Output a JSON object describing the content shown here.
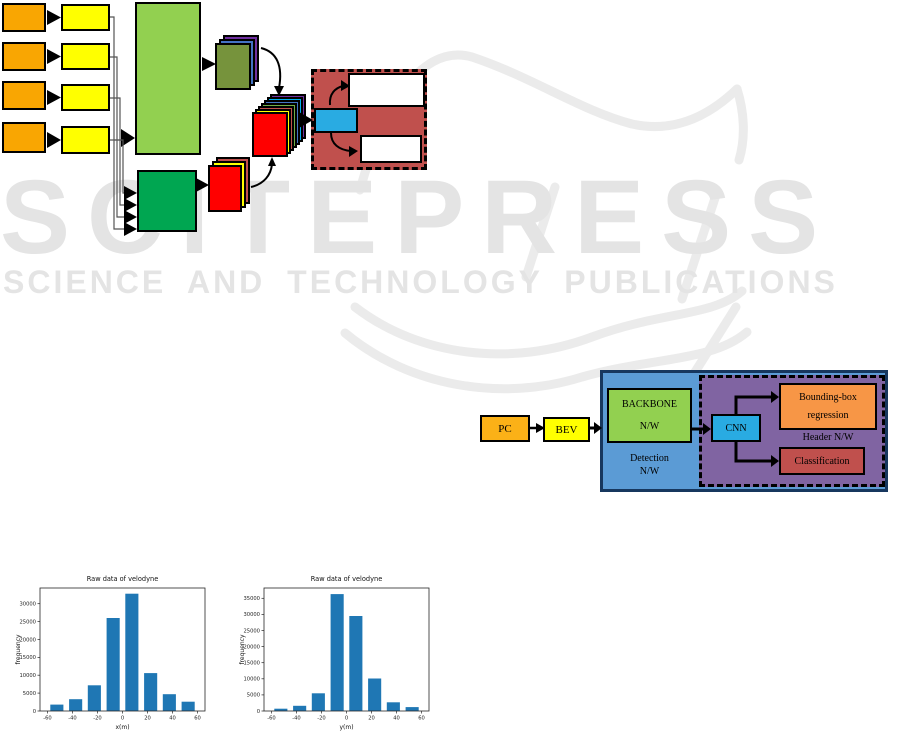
{
  "watermark": {
    "brand": "SCITEPRESS",
    "subtitle": "SCIENCE AND TECHNOLOGY PUBLICATIONS",
    "color": "#e4e4e4"
  },
  "architecture_diagram": {
    "description": "multi-input backbone feature-extraction and detection-head block diagram (no text labels)",
    "colors": {
      "input_orange": "#F9A602",
      "input_yellow": "#FFFF00",
      "backbone_light_green": "#92D050",
      "backbone_dark_green": "#00A651",
      "feature_olive": "#76933C",
      "feature_red": "#FF0000",
      "layer_purple": "#7030A0",
      "layer_blue": "#4472C4",
      "layer_light_blue": "#00B0F0",
      "layer_green": "#70AD47",
      "layer_maroon": "#C0504D",
      "layer_yellow": "#FFFF00",
      "head_background_maroon": "#C0504D",
      "head_cyan": "#29ABE2",
      "head_white": "#FFFFFF"
    }
  },
  "pipeline_diagram": {
    "pc_label": "PC",
    "bev_label": "BEV",
    "backbone_line1": "BACKBONE",
    "backbone_line2": "N/W",
    "detection_line1": "Detection",
    "detection_line2": "N/W",
    "cnn_label": "CNN",
    "bbox_line1": "Bounding-box",
    "bbox_line2": "regression",
    "header_label": "Header N/W",
    "classification_label": "Classification",
    "colors": {
      "pc_orange": "#FBB117",
      "bev_yellow": "#FFFF00",
      "detection_blue": "#5B9BD5",
      "backbone_green": "#92D050",
      "header_purple": "#8064A2",
      "cnn_cyan": "#29ABE2",
      "bbox_orange": "#F79646",
      "classification_red": "#C0504D"
    }
  },
  "chart_data": [
    {
      "type": "bar",
      "title": "Raw data of velodyne",
      "xlabel": "x(m)",
      "ylabel": "frequency",
      "bin_width": 15,
      "bin_centers": [
        -52.5,
        -37.5,
        -22.5,
        -7.5,
        7.5,
        22.5,
        37.5,
        52.5
      ],
      "values": [
        1800,
        3300,
        7200,
        26000,
        32800,
        10600,
        4700,
        2600
      ],
      "xticks": [
        -60,
        -40,
        -20,
        0,
        20,
        40,
        60
      ],
      "yticks": [
        0,
        5000,
        10000,
        15000,
        20000,
        25000,
        30000
      ],
      "xlim": [
        -66,
        66
      ],
      "ylim": [
        0,
        34400
      ],
      "grid": false,
      "legend": "none",
      "bar_color": "#1f77b4"
    },
    {
      "type": "bar",
      "title": "Raw data of velodyne",
      "xlabel": "y(m)",
      "ylabel": "frequency",
      "bin_width": 15,
      "bin_centers": [
        -52.5,
        -37.5,
        -22.5,
        -7.5,
        7.5,
        22.5,
        37.5,
        52.5
      ],
      "values": [
        700,
        1600,
        5500,
        36300,
        29500,
        10100,
        2700,
        1200
      ],
      "xticks": [
        -60,
        -40,
        -20,
        0,
        20,
        40,
        60
      ],
      "yticks": [
        0,
        5000,
        10000,
        15000,
        20000,
        25000,
        30000,
        35000
      ],
      "xlim": [
        -66,
        66
      ],
      "ylim": [
        0,
        38200
      ],
      "grid": false,
      "legend": "none",
      "bar_color": "#1f77b4"
    }
  ]
}
